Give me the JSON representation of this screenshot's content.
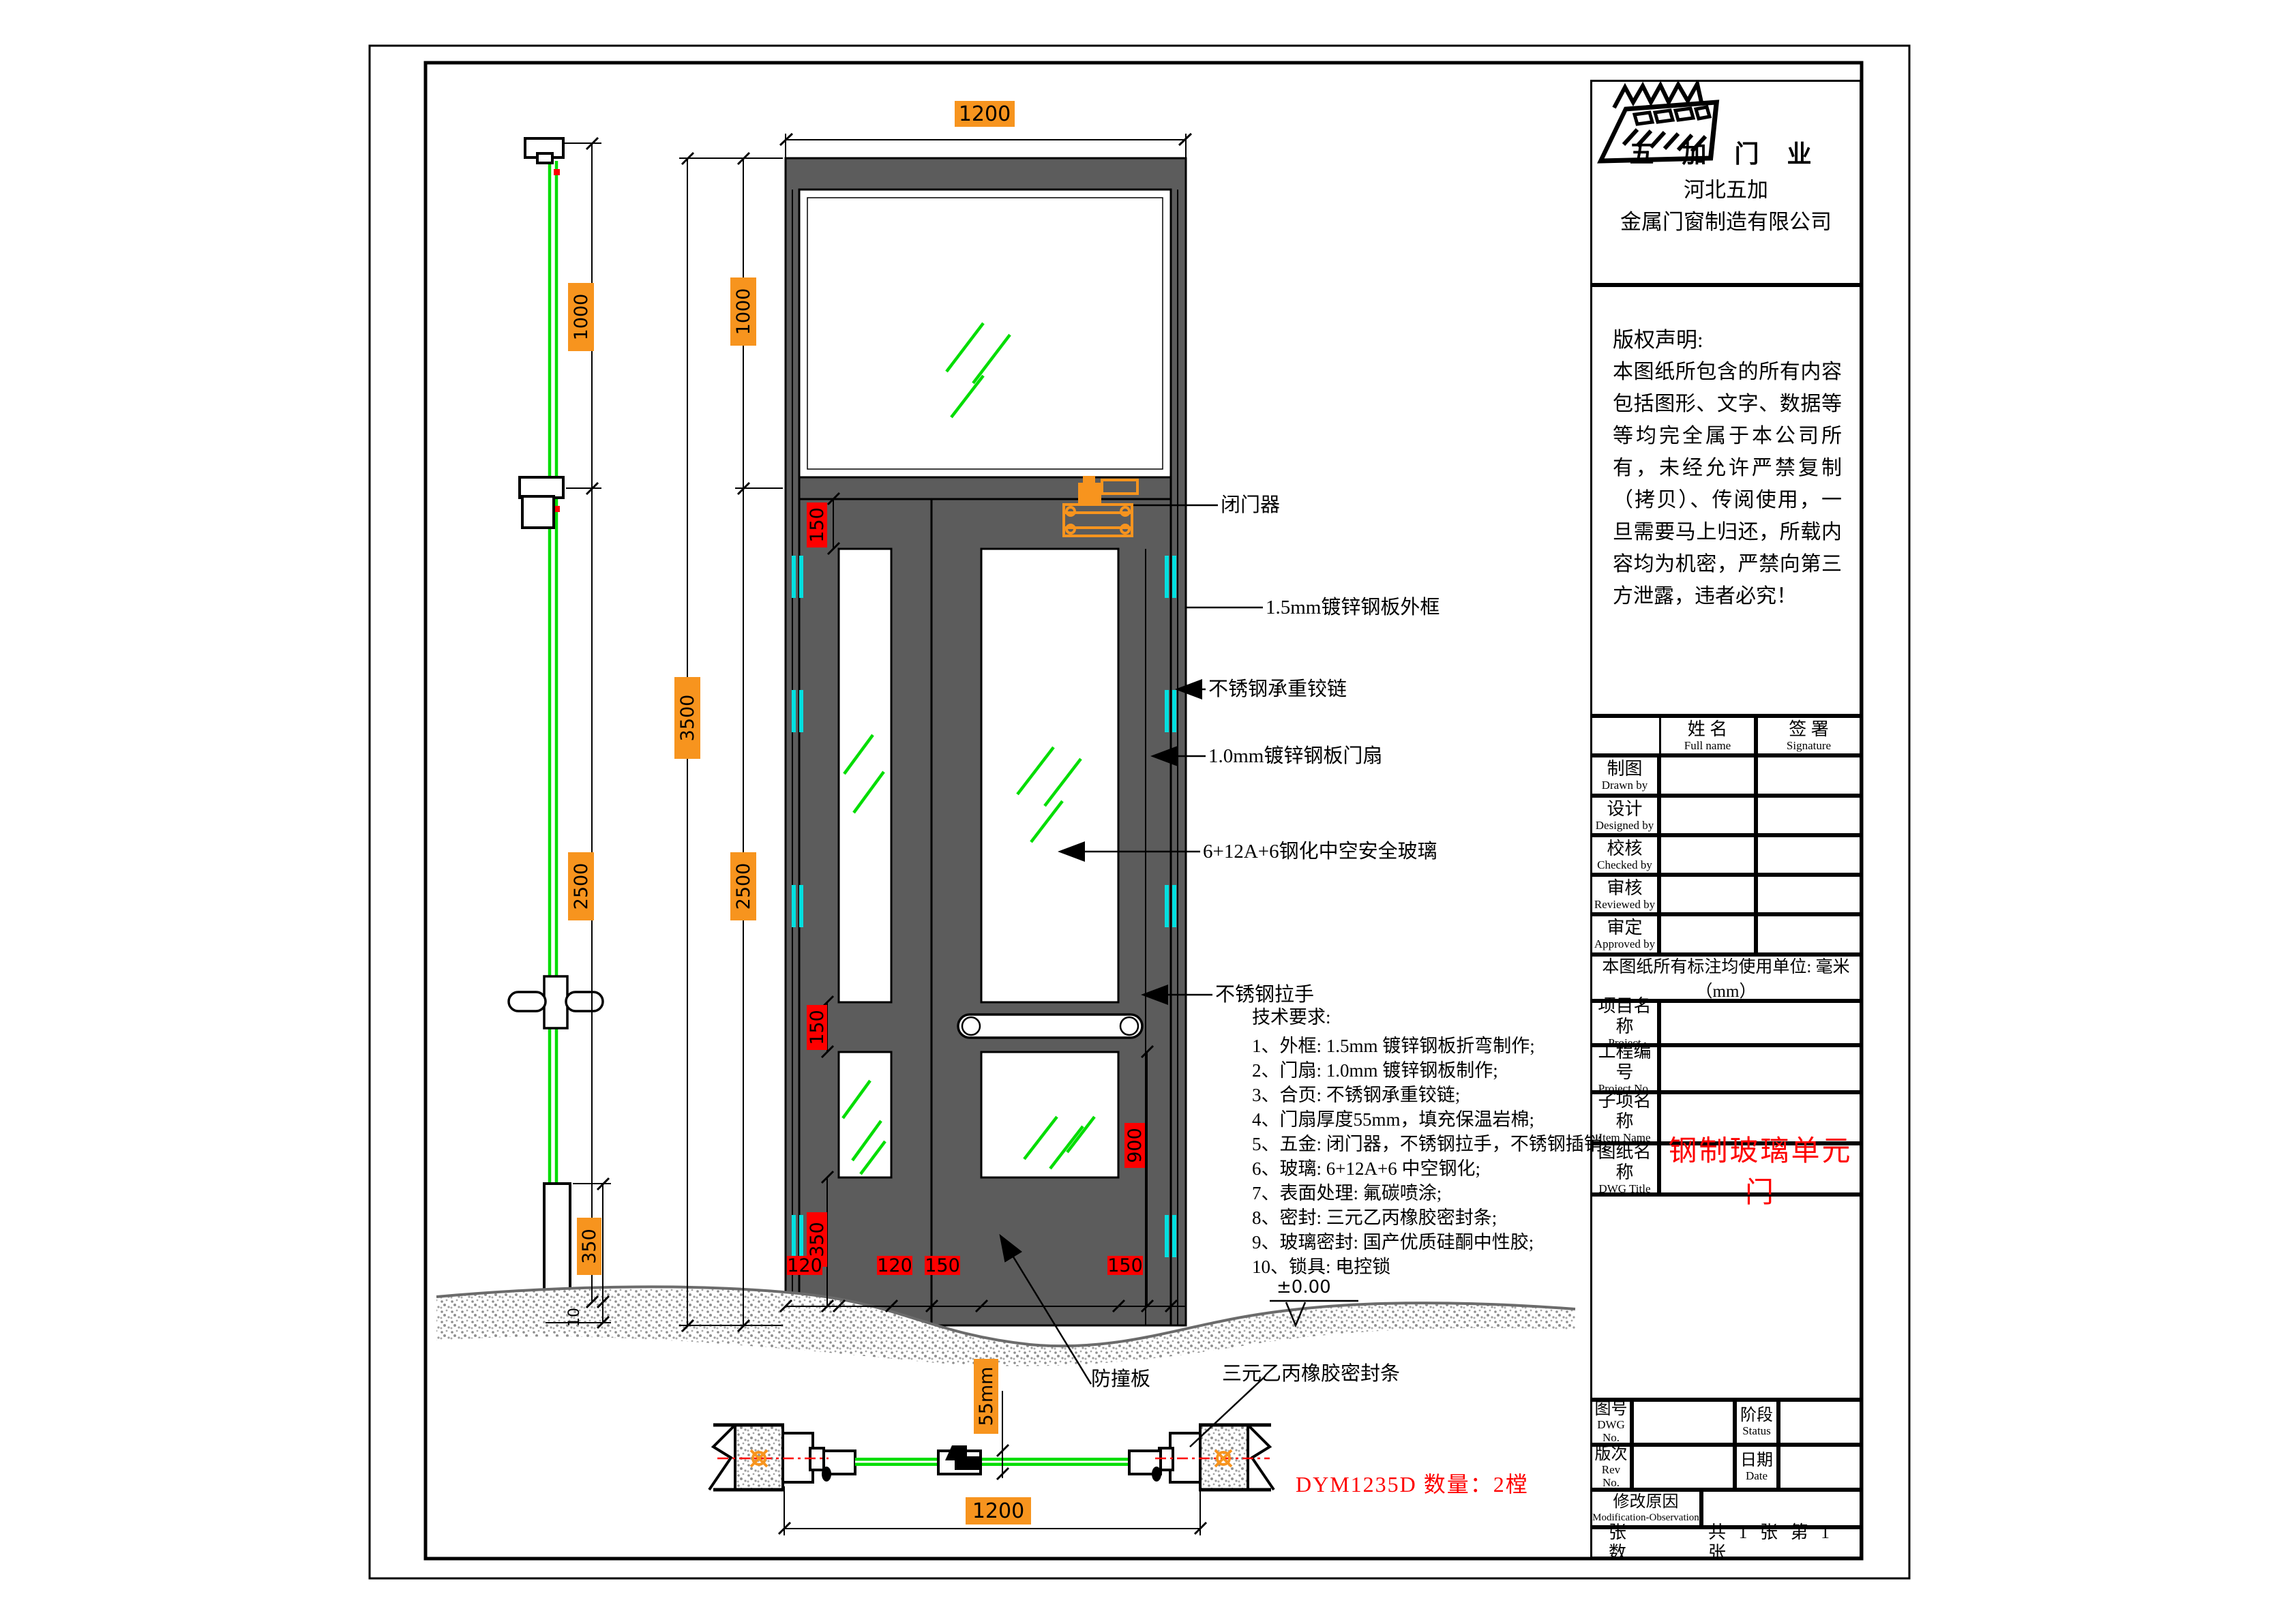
{
  "company": {
    "brand": "五 加 门 业",
    "line1": "河北五加",
    "line2": "金属门窗制造有限公司"
  },
  "copyright": {
    "title": "版权声明:",
    "body": "本图纸所包含的所有内容包括图形、文字、数据等等均完全属于本公司所有，未经允许严禁复制（拷贝）、传阅使用，一旦需要马上归还，所载内容均为机密，严禁向第三方泄露，违者必究！"
  },
  "sign_table": {
    "name_cn": "姓  名",
    "name_en": "Full name",
    "sig_cn": "签  署",
    "sig_en": "Signature",
    "rows": [
      {
        "cn": "制图",
        "en": "Drawn by"
      },
      {
        "cn": "设计",
        "en": "Designed by"
      },
      {
        "cn": "校核",
        "en": "Checked by"
      },
      {
        "cn": "审核",
        "en": "Reviewed by"
      },
      {
        "cn": "审定",
        "en": "Approved by"
      }
    ]
  },
  "units_note": "本图纸所有标注均使用单位: 毫米（mm）",
  "info_rows": [
    {
      "cn": "项目名称",
      "en": "Project",
      "value": ""
    },
    {
      "cn": "工程编号",
      "en": "Project No.",
      "value": ""
    },
    {
      "cn": "子项名称",
      "en": "Item Name",
      "value": ""
    },
    {
      "cn": "图纸名称",
      "en": "DWG Title",
      "value": "钢制玻璃单元门"
    }
  ],
  "bottom_rows": {
    "dwg_no_cn": "图号",
    "dwg_no_en": "DWG No.",
    "status_cn": "阶段",
    "status_en": "Status",
    "rev_cn": "版次",
    "rev_en": "Rev No.",
    "date_cn": "日期",
    "date_en": "Date",
    "mod_cn": "修改原因",
    "mod_en": "Modification-Observation",
    "sheets_label": "张  数",
    "sheets_value": "共 1 张 第 1 张"
  },
  "annotations": {
    "closer": "闭门器",
    "frame": "1.5mm镀锌钢板外框",
    "hinge": "不锈钢承重铰链",
    "leaf": "1.0mm镀锌钢板门扇",
    "glass": "6+12A+6钢化中空安全玻璃",
    "handle": "不锈钢拉手",
    "bump_plate": "防撞板",
    "seal": "三元乙丙橡胶密封条",
    "level": "±0.00",
    "model": "DYM1235D  数量：2樘"
  },
  "tech": {
    "title": "技术要求:",
    "items": [
      "1、外框: 1.5mm 镀锌钢板折弯制作;",
      "2、门扇: 1.0mm 镀锌钢板制作;",
      "3、合页: 不锈钢承重铰链;",
      "4、门扇厚度55mm，填充保温岩棉;",
      "5、五金: 闭门器，不锈钢拉手，不锈钢插销;",
      "6、玻璃: 6+12A+6 中空钢化;",
      "7、表面处理: 氟碳喷涂;",
      "8、密封: 三元乙丙橡胶密封条;",
      "9、玻璃密封: 国产优质硅酮中性胶;",
      "10、锁具: 电控锁"
    ]
  },
  "dims": {
    "top_width": "1200",
    "total_height": "3500",
    "upper": "1000",
    "lower": "2500",
    "side_upper": "1000",
    "side_lower": "2500",
    "side_kick": "350",
    "side_below": "10",
    "rail_top": "150",
    "rail_mid": "150",
    "stile_900": "900",
    "kick_350": "350",
    "w_120a": "120",
    "w_120b": "120",
    "w_150a": "150",
    "w_150b": "150",
    "sec_thickness": "55mm",
    "sec_width": "1200"
  },
  "colors": {
    "frame_gray": "#5c5c5c",
    "glass_green": "#00dd00",
    "hinge_cyan": "#00e0e0",
    "dim_orange": "#f7941e",
    "dim_red": "#fe0000",
    "title_red": "#fe0000"
  }
}
